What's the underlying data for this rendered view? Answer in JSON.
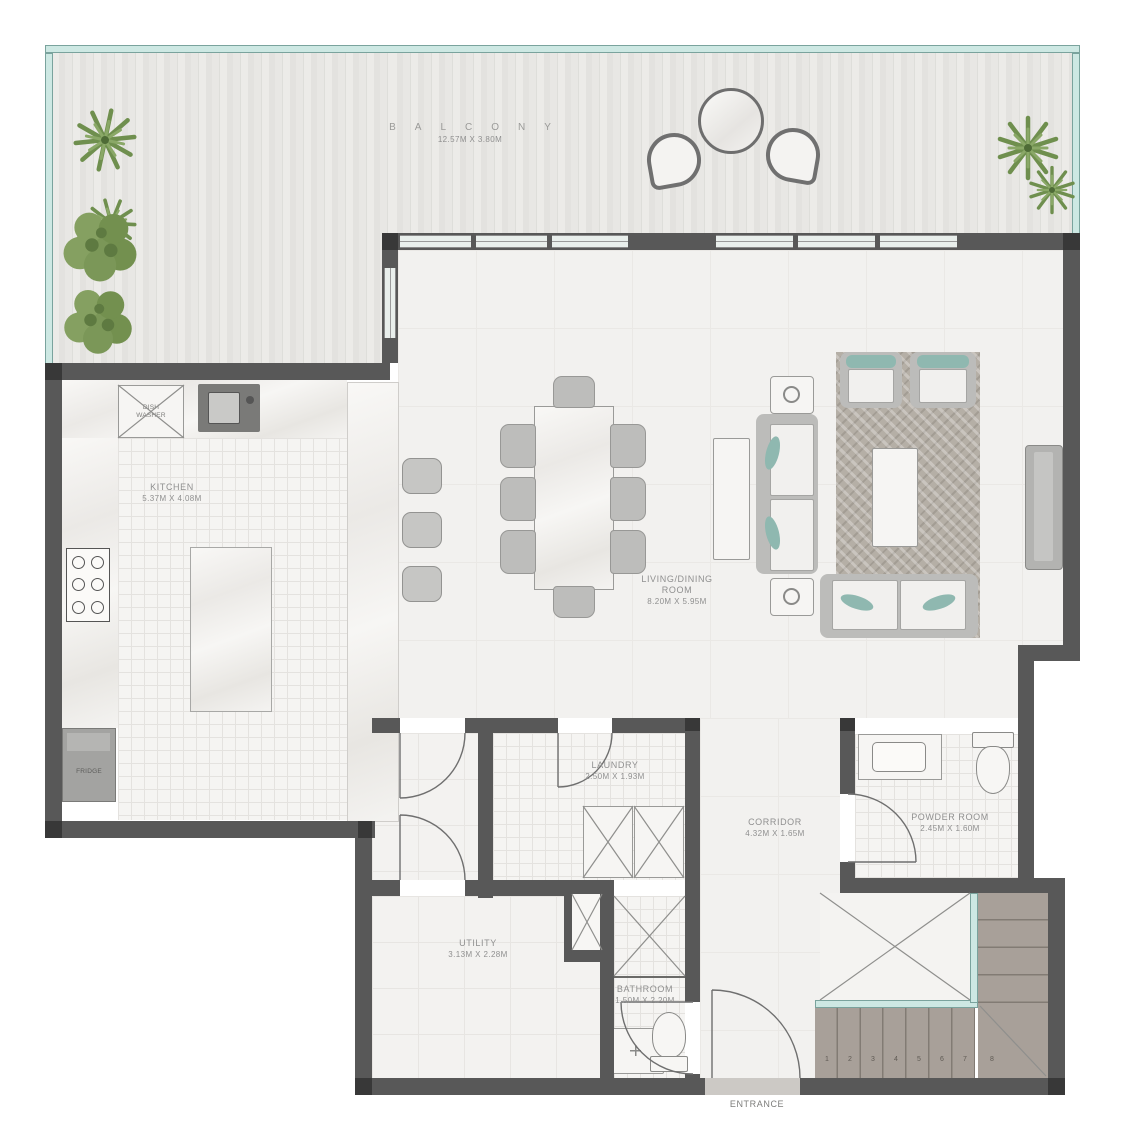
{
  "rooms": {
    "balcony": {
      "name": "BALCONY",
      "dims": "12.57M X 3.80M"
    },
    "kitchen": {
      "name": "KITCHEN",
      "dims": "5.37M X 4.08M"
    },
    "living_dining": {
      "line1": "LIVING/DINING",
      "line2": "ROOM",
      "dims": "8.20M X 5.95M"
    },
    "laundry": {
      "name": "LAUNDRY",
      "dims": "2.50M X 1.93M"
    },
    "corridor": {
      "name": "CORRIDOR",
      "dims": "4.32M X 1.65M"
    },
    "powder_room": {
      "name": "POWDER ROOM",
      "dims": "2.45M X 1.60M"
    },
    "utility": {
      "name": "UTILITY",
      "dims": "3.13M X 2.28M"
    },
    "bathroom": {
      "name": "BATHROOM",
      "dims": "1.50M X 2.20M"
    },
    "entrance": {
      "name": "ENTRANCE"
    }
  },
  "fixtures": {
    "dishwasher_line1": "DISH",
    "dishwasher_line2": "WASHER",
    "fridge": "FRIDGE"
  },
  "stairs": {
    "steps": [
      "1",
      "2",
      "3",
      "4",
      "5",
      "6",
      "7",
      "8"
    ]
  },
  "colors": {
    "wall": "#585858",
    "glass_balustrade": "#cde8e3",
    "teal_accent": "#8fb8b0",
    "stair": "#a8a099",
    "floor": "#f2f1ef",
    "label_text": "#8f8f8f",
    "plant_green": "#6f8f4e"
  }
}
